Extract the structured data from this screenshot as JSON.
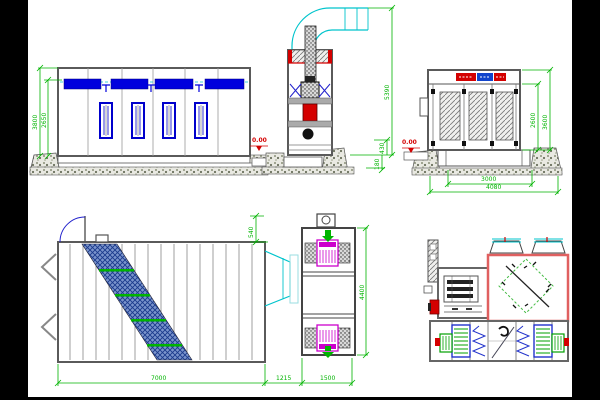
{
  "drawing": {
    "front_elevation": {
      "dim_overall_height": "3800",
      "dim_inner_height": "2650",
      "floor_level": "0.00"
    },
    "side_elevation": {
      "dim_overall_height": "5390",
      "dim_base_height": "430",
      "dim_pit_depth": "180"
    },
    "end_elevation": {
      "floor_level": "0.00",
      "dim_inner_width": "3000",
      "dim_overall_width": "4080",
      "dim_inner_height": "2600",
      "dim_overall_height": "3600"
    },
    "plan_view": {
      "dim_door_offset": "540",
      "dim_booth_length": "7000",
      "dim_duct_section": "1215",
      "dim_fan_unit_width": "1500"
    },
    "fan_unit_plan": {
      "dim_depth": "4400"
    }
  },
  "colors": {
    "dimension": "#00b400",
    "level_marker": "#d40000",
    "lights": "#0000dd",
    "duct": "#00c4cc",
    "fan": "#cc00cc",
    "chamber_outline": "#e06060",
    "body_outline": "#5a5a5a"
  }
}
